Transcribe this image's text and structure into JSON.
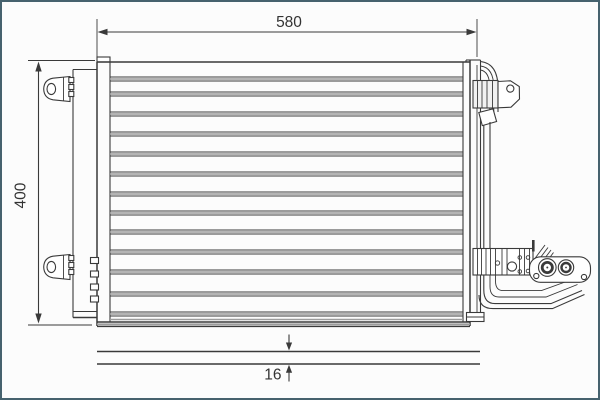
{
  "colors": {
    "ink": "#3a3a3a",
    "tube": "#9c9c9c",
    "frame": "#46626e",
    "background": "#fcfcfc"
  },
  "dimensions": {
    "width_label": "580",
    "height_label": "400",
    "depth_label": "16"
  },
  "diagram": {
    "tube_rows": [
      77,
      92,
      112,
      132,
      152,
      172,
      192,
      211,
      230,
      250,
      270,
      292,
      312
    ],
    "tube_x_start": 110,
    "tube_x_end": 462.5
  }
}
